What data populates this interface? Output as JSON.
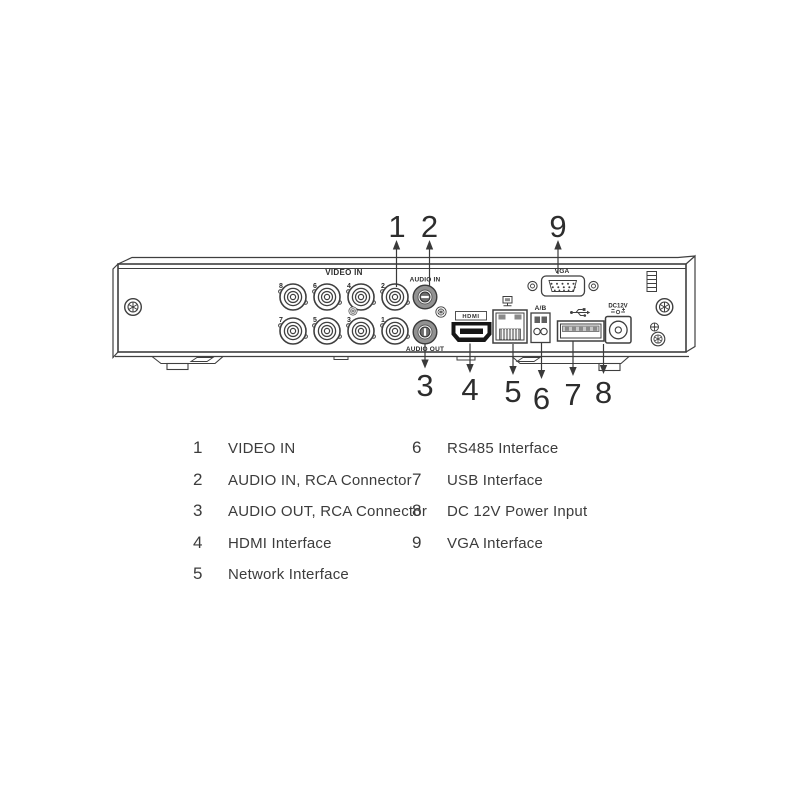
{
  "device": {
    "video_in_label": "VIDEO IN",
    "audio_in_label": "AUDIO IN",
    "audio_out_label": "AUDIO OUT",
    "hdmi_label": "HDMI",
    "ab_label": "A/B",
    "vga_label": "VGA",
    "dc_label": "DC12V",
    "bnc_top": [
      "8",
      "6",
      "4",
      "2"
    ],
    "bnc_bottom": [
      "7",
      "5",
      "3",
      "1"
    ],
    "callouts": {
      "c1": "1",
      "c2": "2",
      "c3": "3",
      "c4": "4",
      "c5": "5",
      "c6": "6",
      "c7": "7",
      "c8": "8",
      "c9": "9"
    },
    "icons": {
      "network": "network-icon",
      "usb": "usb-trident-icon",
      "dc_polarity": "dc-polarity-icon",
      "ground": "ground-screw-icon"
    }
  },
  "legend": {
    "items": [
      {
        "num": "1",
        "label": "VIDEO IN"
      },
      {
        "num": "2",
        "label": "AUDIO IN, RCA Connector"
      },
      {
        "num": "3",
        "label": "AUDIO OUT, RCA Connector"
      },
      {
        "num": "4",
        "label": "HDMI Interface"
      },
      {
        "num": "5",
        "label": "Network Interface"
      },
      {
        "num": "6",
        "label": "RS485 Interface"
      },
      {
        "num": "7",
        "label": "USB Interface"
      },
      {
        "num": "8",
        "label": "DC 12V Power Input"
      },
      {
        "num": "9",
        "label": "VGA Interface"
      }
    ]
  },
  "colors": {
    "line": "#3f3f3f",
    "text": "#3c3c3c"
  }
}
